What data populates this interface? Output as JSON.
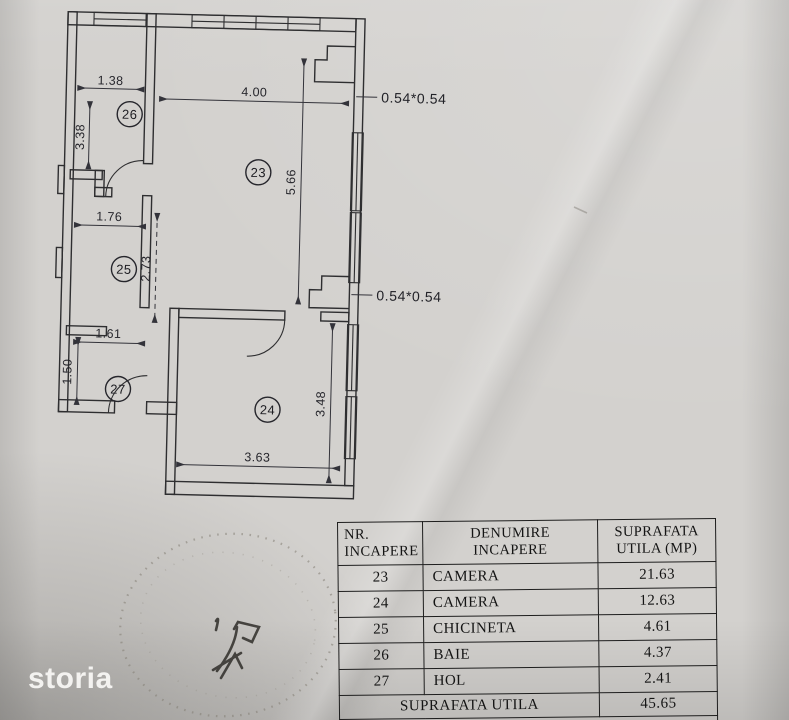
{
  "plan": {
    "room_numbers": {
      "r23": "23",
      "r24": "24",
      "r25": "25",
      "r26": "26",
      "r27": "27"
    },
    "dims": {
      "w26": "1.38",
      "h26": "3.38",
      "w23": "4.00",
      "h23": "5.66",
      "w25": "1.76",
      "h25": "2.73",
      "w27": "1.61",
      "h27": "1.50",
      "h24": "3.48",
      "w24": "3.63",
      "pillar_top": "0.54*0.54",
      "pillar_bottom": "0.54*0.54"
    }
  },
  "table": {
    "headers": [
      {
        "line1": "NR.",
        "line2": "INCAPERE"
      },
      {
        "line1": "DENUMIRE",
        "line2": "INCAPERE"
      },
      {
        "line1": "SUPRAFATA",
        "line2": "UTILA (MP)"
      }
    ],
    "rows": [
      {
        "nr": "23",
        "name": "CAMERA",
        "area": "21.63"
      },
      {
        "nr": "24",
        "name": "CAMERA",
        "area": "12.63"
      },
      {
        "nr": "25",
        "name": "CHICINETA",
        "area": "4.61"
      },
      {
        "nr": "26",
        "name": "BAIE",
        "area": "4.37"
      },
      {
        "nr": "27",
        "name": "HOL",
        "area": "2.41"
      }
    ],
    "footer": {
      "label": "SUPRAFATA UTILA",
      "value": "45.65"
    }
  },
  "watermark": "storia"
}
